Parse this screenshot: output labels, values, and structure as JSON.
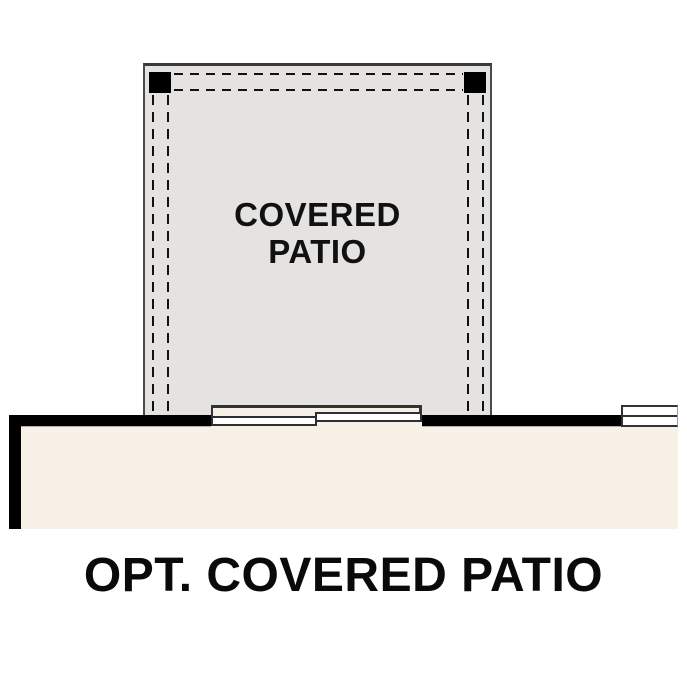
{
  "plan": {
    "patio_label_line1": "COVERED",
    "patio_label_line2": "PATIO",
    "caption": "OPT. COVERED PATIO"
  },
  "colors": {
    "patio_fill": "#e4e3e1",
    "interior_fill": "#f7f0e7",
    "wall": "#000000",
    "outline": "#3a3a3a",
    "dashed_line": "#111111",
    "door_panel_fill": "#ffffff",
    "text": "#0a0a0a",
    "background": "#ffffff"
  }
}
